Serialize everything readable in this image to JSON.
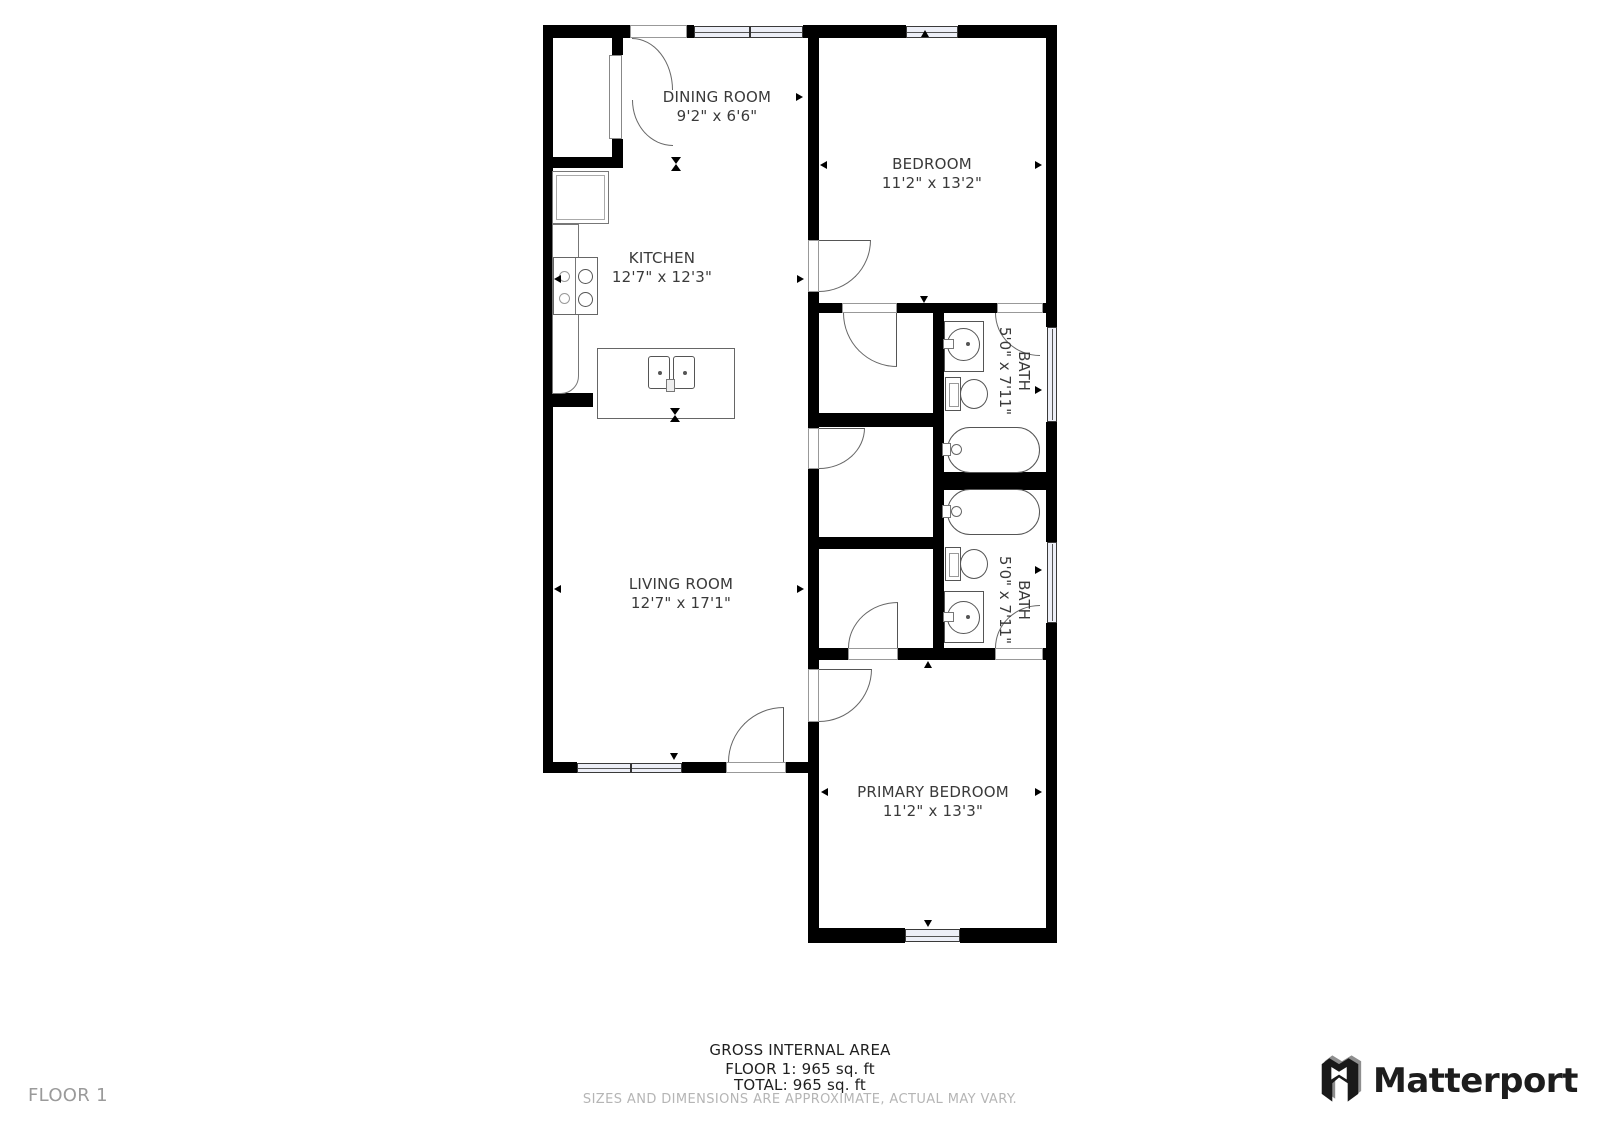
{
  "plan": {
    "rooms": [
      {
        "name": "DINING ROOM",
        "dims": "9'2\" x 6'6\""
      },
      {
        "name": "BEDROOM",
        "dims": "11'2\" x 13'2\""
      },
      {
        "name": "KITCHEN",
        "dims": "12'7\" x 12'3\""
      },
      {
        "name": "BATH",
        "dims": "5'0\" x 7'11\""
      },
      {
        "name": "LIVING ROOM",
        "dims": "12'7\" x 17'1\""
      },
      {
        "name": "BATH",
        "dims": "5'0\" x 7'11\""
      },
      {
        "name": "PRIMARY BEDROOM",
        "dims": "11'2\" x 13'3\""
      }
    ]
  },
  "footer": {
    "gross_title": "GROSS INTERNAL AREA",
    "floor_area": "FLOOR 1: 965 sq. ft",
    "total_area": "TOTAL: 965 sq. ft",
    "disclaimer": "SIZES AND DIMENSIONS ARE APPROXIMATE, ACTUAL MAY VARY.",
    "floor_label": "FLOOR 1"
  },
  "brand": {
    "name": "Matterport"
  },
  "colors": {
    "wall": "#000000",
    "window_fill": "#edeff7",
    "label_text": "#3a3a3a",
    "muted_text": "#b5b5b5",
    "brand_text": "#1d1d1d"
  }
}
